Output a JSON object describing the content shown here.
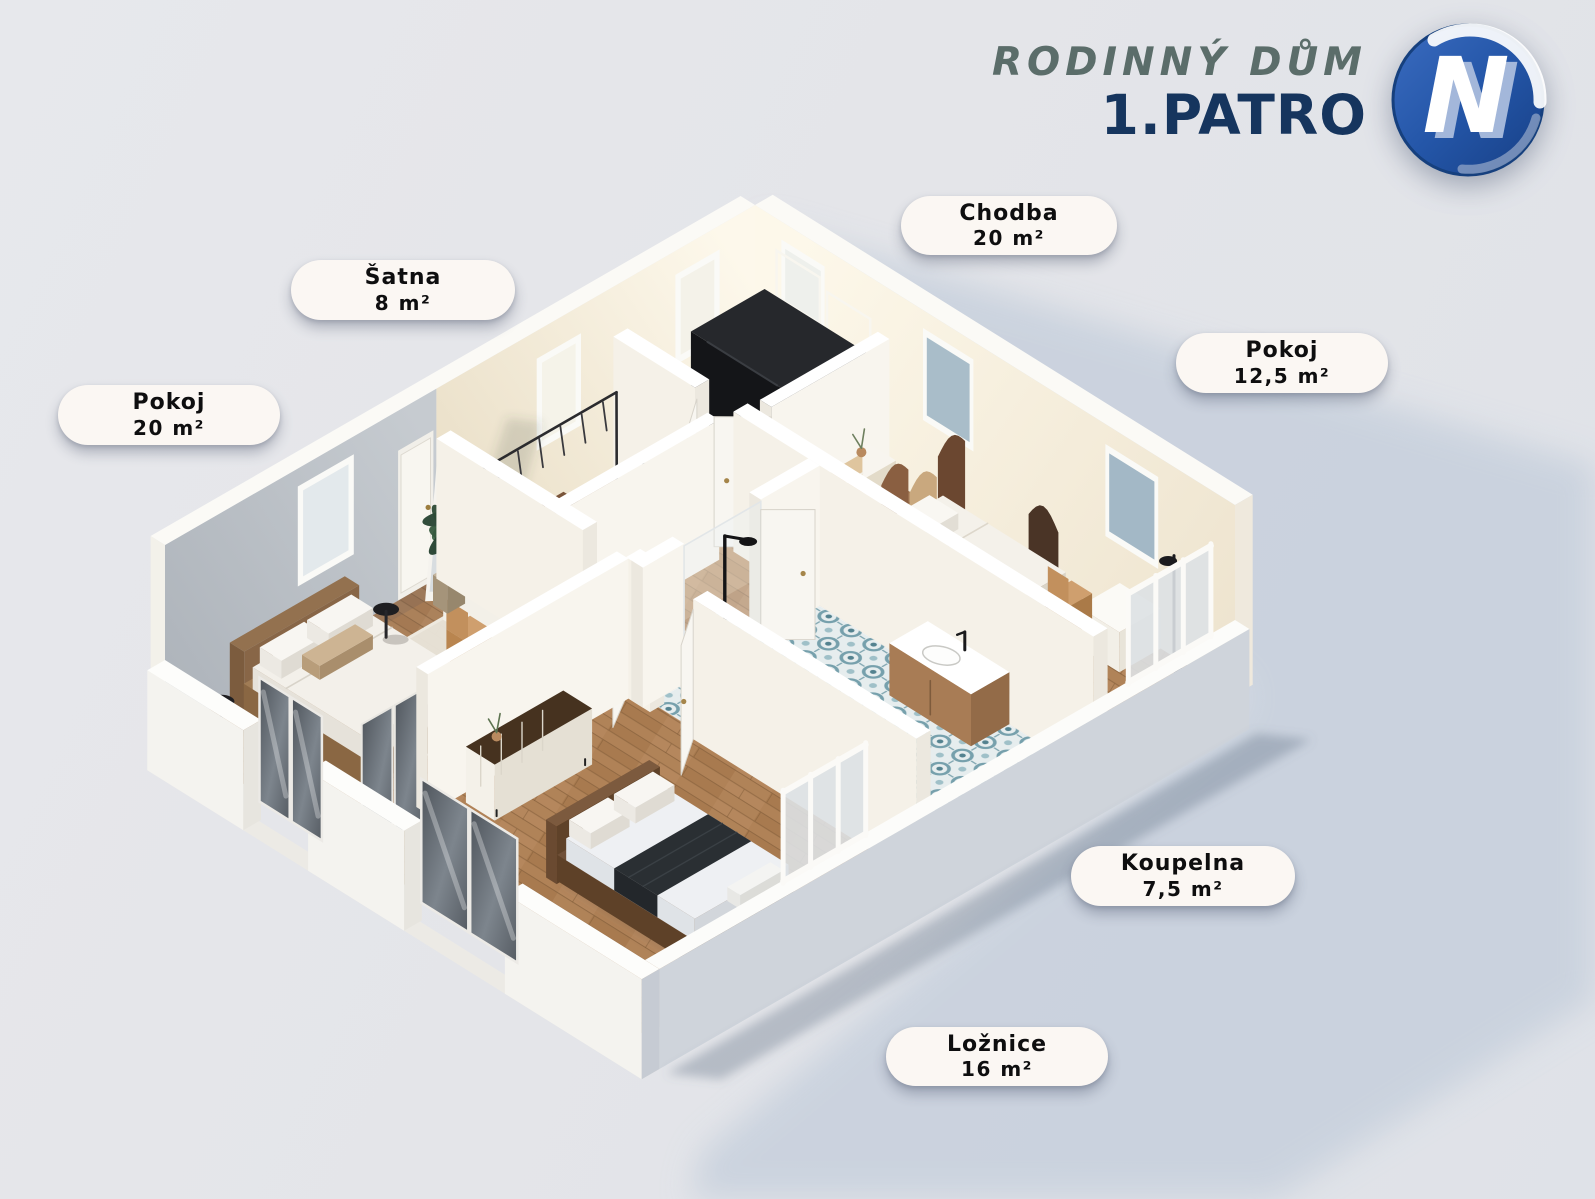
{
  "header": {
    "title": "RODINNÝ DŮM",
    "subtitle": "1.PATRO",
    "logo_letter": "N"
  },
  "rooms": [
    {
      "id": "pokoj-20",
      "name": "Pokoj",
      "area": "20 m²"
    },
    {
      "id": "satna",
      "name": "Šatna",
      "area": "8 m²"
    },
    {
      "id": "chodba",
      "name": "Chodba",
      "area": "20 m²"
    },
    {
      "id": "pokoj-12-5",
      "name": "Pokoj",
      "area": "12,5 m²"
    },
    {
      "id": "koupelna",
      "name": "Koupelna",
      "area": "7,5 m²"
    },
    {
      "id": "loznice",
      "name": "Ložnice",
      "area": "16 m²"
    }
  ],
  "colors": {
    "logo_blue": "#2a58a8",
    "logo_ring": "#16407e",
    "logo_light_n": "#a3b7da",
    "title_green": "#5b6d6a",
    "subtitle_navy": "#16355e",
    "label_bg": "#fbf7f3"
  }
}
